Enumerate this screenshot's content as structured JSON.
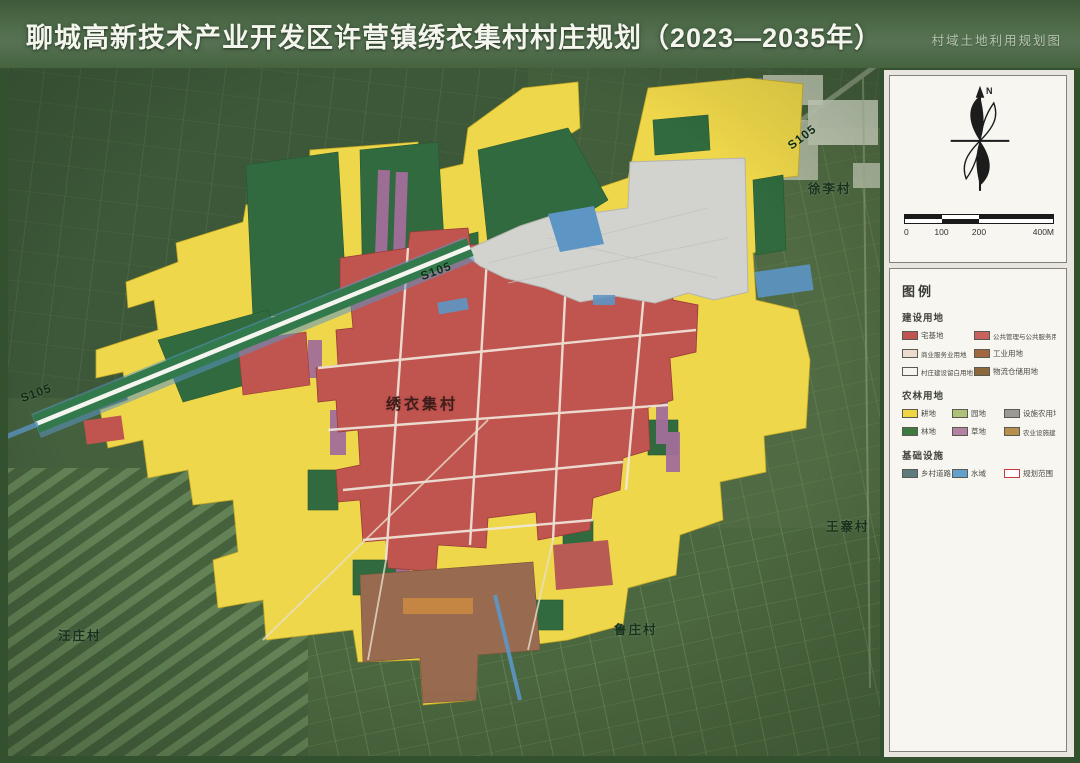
{
  "header": {
    "title": "聊城高新技术产业开发区许营镇绣衣集村村庄规划（2023—2035年）",
    "corner_note": "村域土地利用规划图"
  },
  "map": {
    "labels": {
      "road_left": "S105",
      "road_mid": "S105",
      "road_topright": "S105",
      "village_center": "绣衣集村",
      "village_topright": "徐李村",
      "village_right": "王寨村",
      "village_bottom": "鲁庄村",
      "village_bottomleft": "汪庄村"
    }
  },
  "panel": {
    "compass_label": "N",
    "scale": {
      "ticks": [
        "0",
        "100",
        "200",
        "400M"
      ]
    },
    "legend": {
      "title": "图例",
      "groups": [
        {
          "name": "建设用地",
          "items": [
            {
              "label": "宅基地",
              "color": "#bf5450"
            },
            {
              "label": "公共管理与公共服务用地",
              "color": "#c9625c"
            },
            {
              "label": "商业服务业用地",
              "color": "#ecdccf"
            },
            {
              "label": "工业用地",
              "color": "#a2673e"
            },
            {
              "label": "村庄建设留白用地",
              "color": "#f6f4ee"
            },
            {
              "label": "物流仓储用地",
              "color": "#8b693d"
            }
          ]
        },
        {
          "name": "农林用地",
          "items": [
            {
              "label": "耕地",
              "color": "#efd743"
            },
            {
              "label": "园地",
              "color": "#adc179"
            },
            {
              "label": "设施农用地",
              "color": "#9a9a92"
            },
            {
              "label": "林地",
              "color": "#3c7a40"
            },
            {
              "label": "草地",
              "color": "#b383a3"
            },
            {
              "label": "农业设施建设用地",
              "color": "#b7904d"
            }
          ]
        },
        {
          "name": "基础设施",
          "items": [
            {
              "label": "乡村道路",
              "color": "#5e7c7c"
            },
            {
              "label": "水域",
              "color": "#64a0cc"
            },
            {
              "label": "规划范围",
              "color": "#ffffff",
              "outline": "#cc3b3b"
            }
          ]
        }
      ]
    }
  },
  "colors": {
    "farmland_yellow": "#efd743",
    "village_red": "#c4534e",
    "forest_green": "#2e6b3c",
    "reserved_gray": "#d2d2cf",
    "water_blue": "#5a96c8",
    "road_green": "#2f7a4a"
  }
}
